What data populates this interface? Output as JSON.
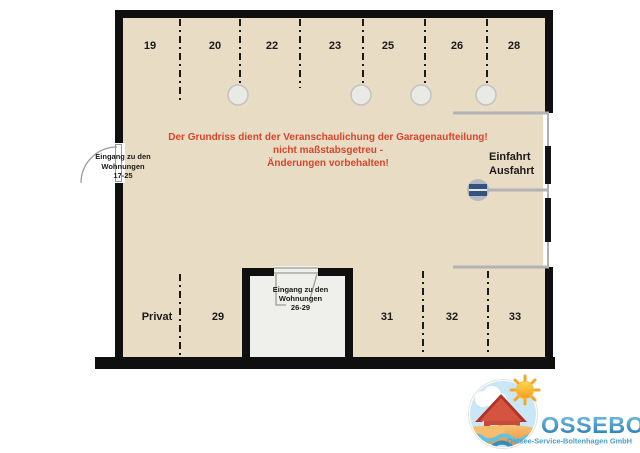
{
  "floorplan": {
    "disclaimer": {
      "line1": "Der Grundriss dient der Veranschaulichung der Garagenaufteilung!",
      "line2": "nicht maßstabsgetreu -",
      "line3": "Änderungen vorbehalten!",
      "color": "#d9452a"
    },
    "stalls_top": [
      {
        "label": "19"
      },
      {
        "label": "20"
      },
      {
        "label": "22"
      },
      {
        "label": "23"
      },
      {
        "label": "25"
      },
      {
        "label": "26"
      },
      {
        "label": "28"
      }
    ],
    "stalls_bottom": [
      {
        "label": "Privat"
      },
      {
        "label": "29"
      },
      {
        "label": "31"
      },
      {
        "label": "32"
      },
      {
        "label": "33"
      }
    ],
    "entrance_exit": {
      "line1": "Einfahrt",
      "line2": "Ausfahrt"
    },
    "door_left": {
      "line1": "Eingang zu den",
      "line2": "Wohnungen",
      "line3": "17-25"
    },
    "door_room": {
      "line1": "Eingang zu den",
      "line2": "Wohnungen",
      "line3": "26-29"
    },
    "colors": {
      "floor": "#e8dcc5",
      "wall": "#0f0f0f",
      "room_floor": "#efefec",
      "lane_line": "#b3b3b3",
      "barrier_blue": "#33527e",
      "pillar_fill": "#e9e9e6"
    }
  },
  "logo": {
    "name": "OSSEBO",
    "subtitle": "Ostsee-Service-Boltenhagen GmbH",
    "colors": {
      "text_top": "#7fc4e6",
      "text_bottom": "#1e78ad",
      "subtitle": "#4aa0cc",
      "sky": "#c9e7f7",
      "house": "#c0392b",
      "sun": "#f5a623",
      "sand": "#f2a24e",
      "wave": "#2e8fc0"
    },
    "icons": [
      "sun-icon",
      "cloud-icon",
      "house-icon",
      "sand-icon",
      "waves-icon"
    ]
  }
}
